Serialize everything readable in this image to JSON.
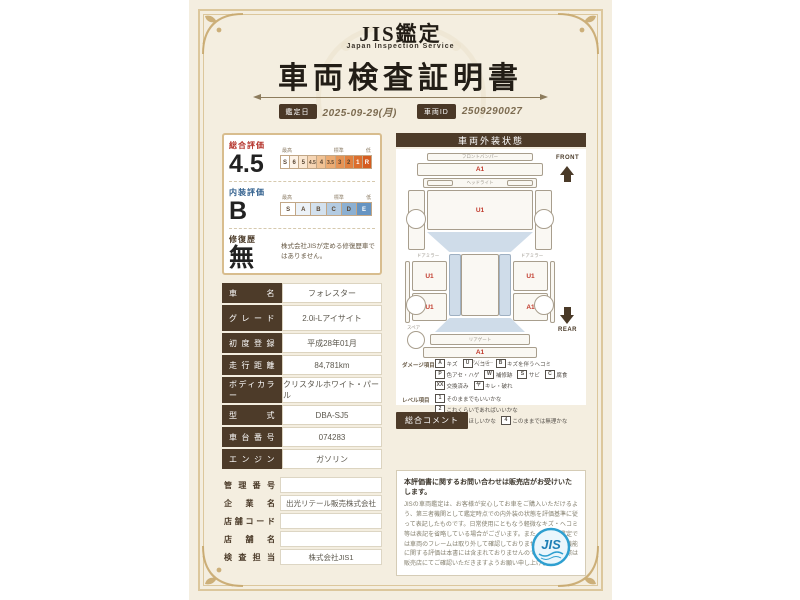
{
  "page": {
    "brand_title": "JIS鑑定",
    "brand_subtitle": "Japan Inspection Service",
    "doc_title": "車両検査証明書",
    "date_label": "鑑定日",
    "date_value": "2025-09-29(月)",
    "id_label": "車両ID",
    "id_value": "2509290027"
  },
  "evaluation": {
    "scale_heads": {
      "high": "最高",
      "mid": "標準",
      "low": "低"
    },
    "overall": {
      "label": "総合評価",
      "value": "4.5",
      "scale": [
        "S",
        "6",
        "5",
        "4.5",
        "4",
        "3.5",
        "3",
        "2",
        "1",
        "R"
      ]
    },
    "interior": {
      "label": "内装評価",
      "value": "B",
      "scale": [
        "S",
        "A",
        "B",
        "C",
        "D",
        "E"
      ]
    },
    "repair": {
      "label": "修復歴",
      "value": "無",
      "note": "株式会社JISが定める修復歴車ではありません。"
    }
  },
  "vehicle": {
    "rows": [
      {
        "label": "車名",
        "value": "フォレスター"
      },
      {
        "label": "グレード",
        "value": "2.0i-Lアイサイト"
      },
      {
        "label": "初度登録",
        "value": "平成28年01月"
      },
      {
        "label": "走行距離",
        "value": "84,781km"
      },
      {
        "label": "ボディカラー",
        "value": "クリスタルホワイト・パール"
      },
      {
        "label": "型式",
        "value": "DBA-SJ5"
      },
      {
        "label": "車台番号",
        "value": "074283"
      },
      {
        "label": "エンジン",
        "value": "ガソリン"
      }
    ]
  },
  "dealer": {
    "rows": [
      {
        "label": "管理番号",
        "value": ""
      },
      {
        "label": "企業名",
        "value": "出光リテール販売株式会社"
      },
      {
        "label": "店舗コード",
        "value": ""
      },
      {
        "label": "店舗名",
        "value": ""
      },
      {
        "label": "検査担当",
        "value": "株式会社JIS1"
      }
    ]
  },
  "exterior": {
    "header": "車両外装状態",
    "front_label": "FRONT",
    "rear_label": "REAR",
    "parts": {
      "front_bumper_label": "フロントバンパー",
      "headlight_label": "ヘッドライト",
      "mirror_label": "ドアミラー",
      "rear_gate_label": "リアゲート",
      "rear_bumper_label": "リアバンパー",
      "spare_label": "スペア"
    },
    "marks": {
      "front_bumper": "A1",
      "bonnet": "U1",
      "door_left": "U1",
      "door_right": "U1",
      "quarter_left": "U1",
      "quarter_right": "A1",
      "rear_bumper": "A1"
    },
    "damage_legend": {
      "label": "ダメージ項目",
      "items": [
        {
          "code": "A",
          "text": "キズ"
        },
        {
          "code": "U",
          "text": "ヘコミ"
        },
        {
          "code": "B",
          "text": "キズを伴うヘコミ"
        },
        {
          "code": "P",
          "text": "色アセ・ハゲ"
        },
        {
          "code": "W",
          "text": "補修跡"
        },
        {
          "code": "S",
          "text": "サビ"
        },
        {
          "code": "C",
          "text": "腐食"
        },
        {
          "code": "XX",
          "text": "交換済み"
        },
        {
          "code": "ヤ",
          "text": "キレ・破れ"
        }
      ]
    },
    "level_legend": {
      "label": "レベル項目",
      "items": [
        {
          "code": "1",
          "text": "そのままでもいいかな"
        },
        {
          "code": "2",
          "text": "これくらいであればいいかな"
        },
        {
          "code": "3",
          "text": "修理してほしいかな"
        },
        {
          "code": "4",
          "text": "このままでは無理かな"
        }
      ]
    },
    "comment_label": "総合コメント"
  },
  "footer": {
    "heading": "本評価書に関するお問い合わせは販売店がお受けいたします。",
    "body": "JISの車両鑑定は、お客様が安心してお車をご購入いただけるよう、第三者機関として鑑定時点での内外装の状態を評価基準に従って表記したものです。日常使用にともなう軽微なキズ・ヘコミ等は表記を省略している場合がございます。また、当社の鑑定では車両のフレームは取り外して確認しておりません。機関・機能に関する評価は本書には含まれておりませんので、ご購入の際は販売店にてご確認いただきますようお願い申し上げます。",
    "logo_text": "JIS"
  },
  "colors": {
    "accent_red": "#b5342c",
    "accent_blue": "#33618e",
    "brown": "#4d3b29",
    "gold": "#dcc79c",
    "stamp_blue": "#2e9fd0"
  }
}
